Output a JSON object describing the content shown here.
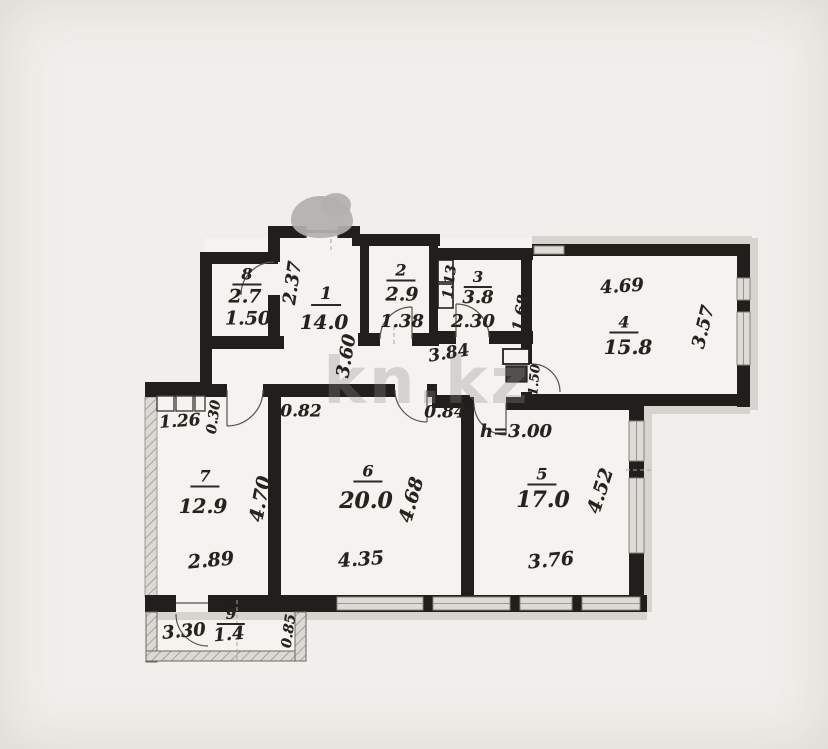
{
  "watermark": "kn.kz",
  "rooms": {
    "r1": {
      "number": "1",
      "area": "14.0",
      "dim_side": "2.37",
      "dim_depth": "3.60"
    },
    "r2": {
      "number": "2",
      "area": "2.9",
      "dim_width": "1.38"
    },
    "r3": {
      "number": "3",
      "area": "3.8",
      "dim_width": "2.30",
      "dim_left": "1.13",
      "dim_right": "1.68"
    },
    "r4": {
      "number": "4",
      "area": "15.8",
      "dim_width": "4.69",
      "dim_depth": "3.57"
    },
    "r5": {
      "number": "5",
      "area": "17.0",
      "ceiling_height": "h=3.00",
      "dim_width": "3.76",
      "dim_depth": "4.52"
    },
    "r6": {
      "number": "6",
      "area": "20.0",
      "dim_top_left": "0.82",
      "dim_top_right": "0.84",
      "dim_width": "4.35",
      "dim_depth": "4.68"
    },
    "r7": {
      "number": "7",
      "area": "12.9",
      "dim_width": "2.89",
      "dim_depth": "4.70",
      "dim_niche_width": "1.26",
      "dim_niche_depth": "0.30"
    },
    "r8": {
      "number": "8",
      "area": "2.7",
      "dim_width": "1.50"
    },
    "r9": {
      "number": "9",
      "area": "1.4",
      "dim_width": "3.30",
      "dim_depth": "0.85"
    },
    "corridor": {
      "dim_width": "3.84",
      "dim_duct": "1.50"
    }
  },
  "colors": {
    "wall": "#211f1c",
    "window_fill": "#dedbd6",
    "outer_band": "#d7d4cf",
    "paper": "#f5f3ef"
  }
}
